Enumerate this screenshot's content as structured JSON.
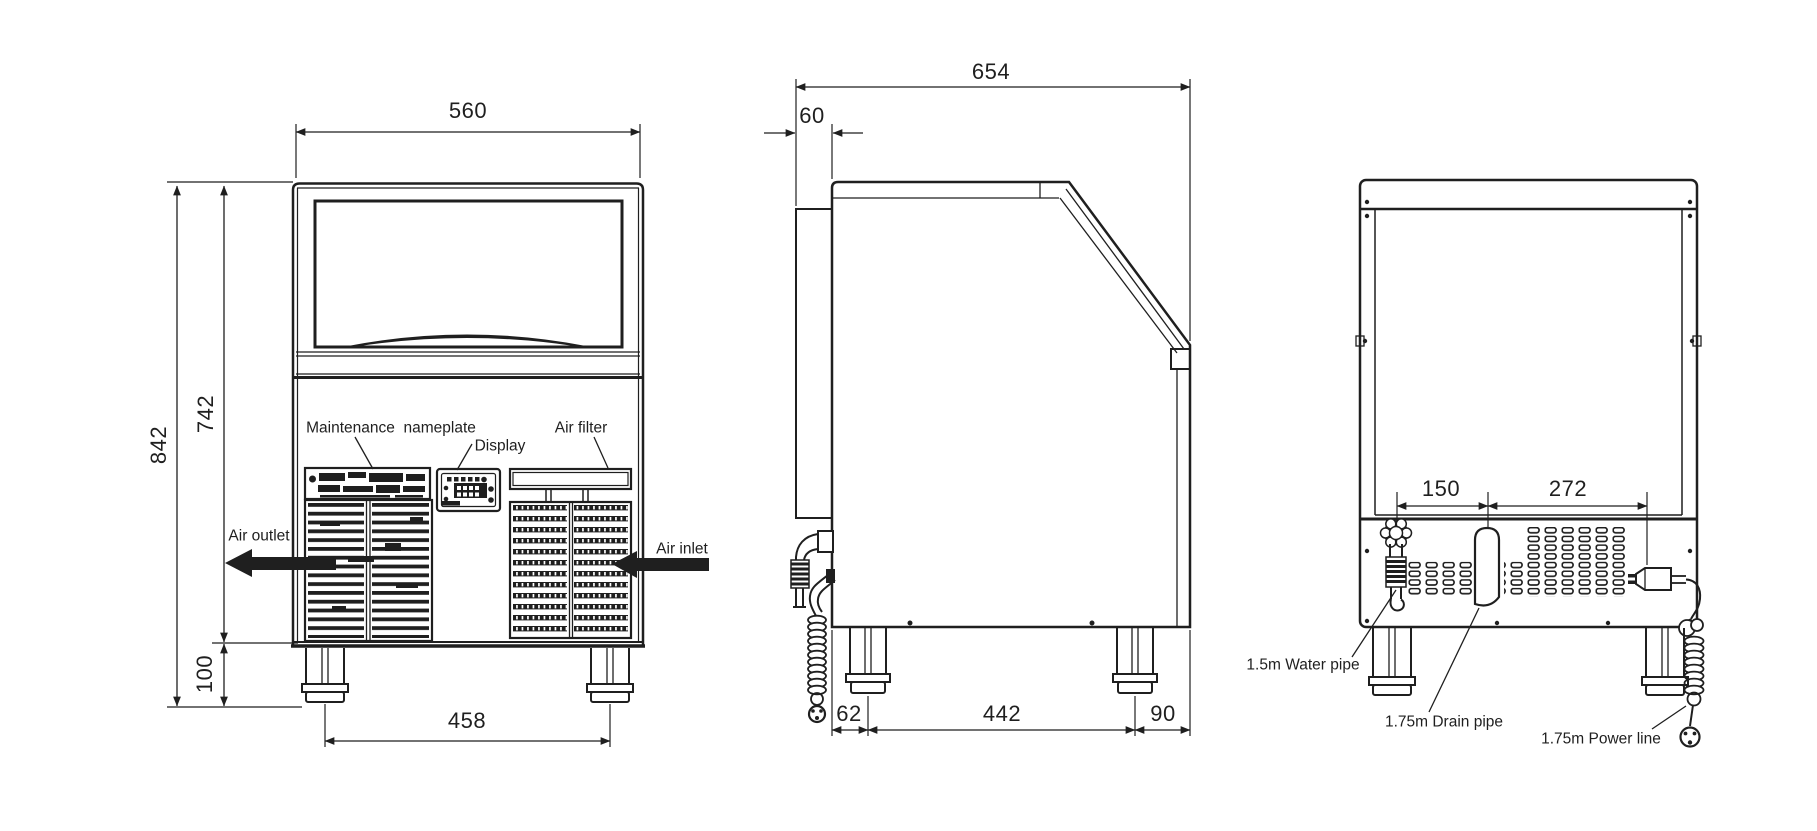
{
  "colors": {
    "ink": "#1f1f1f",
    "bg": "#ffffff"
  },
  "front_view": {
    "dims": {
      "width": "560",
      "height_total": "842",
      "height_body": "742",
      "leg_height": "100",
      "leg_span": "458"
    },
    "labels": {
      "nameplate": "Maintenance  nameplate",
      "display": "Display",
      "air_filter": "Air filter",
      "air_outlet": "Air outlet",
      "air_inlet": "Air inlet"
    }
  },
  "side_view": {
    "dims": {
      "depth": "654",
      "back_panel": "60",
      "back_to_leg": "62",
      "leg_span": "442",
      "leg_to_front": "90"
    }
  },
  "rear_view": {
    "dims": {
      "water_to_drain": "150",
      "drain_to_power": "272"
    },
    "labels": {
      "water": "1.5m Water pipe",
      "drain": "1.75m Drain pipe",
      "power": "1.75m Power line"
    }
  }
}
